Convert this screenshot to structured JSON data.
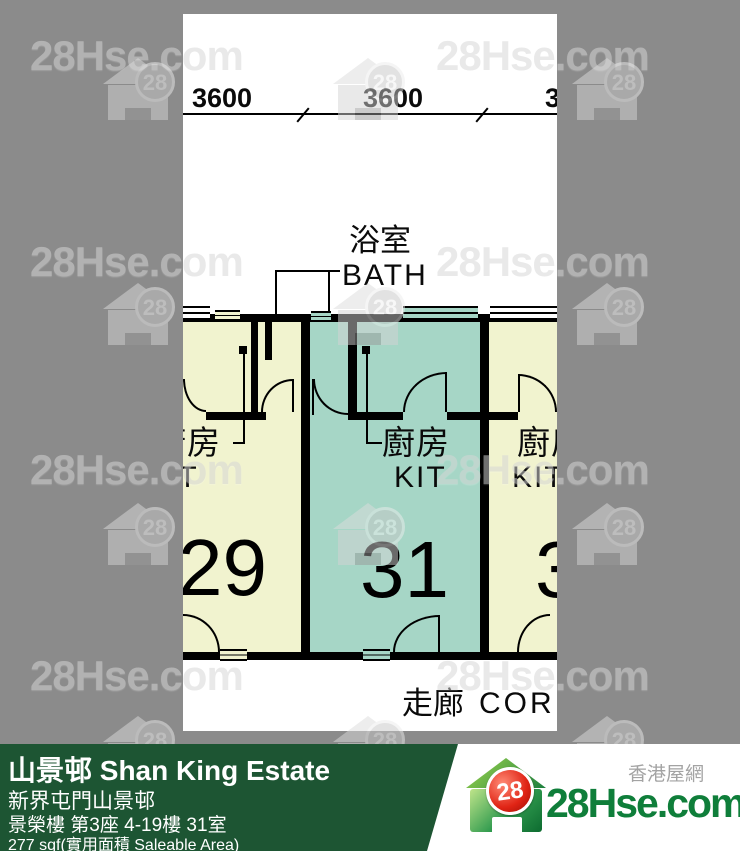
{
  "page": {
    "background_color": "#8b8b8b"
  },
  "watermark": {
    "text": "28Hse.com",
    "badge": "28",
    "text_positions": [
      [
        30,
        32
      ],
      [
        436,
        32
      ],
      [
        30,
        238
      ],
      [
        436,
        238
      ],
      [
        30,
        446
      ],
      [
        436,
        446
      ],
      [
        30,
        652
      ],
      [
        436,
        652
      ]
    ],
    "logo_positions": [
      [
        103,
        58
      ],
      [
        333,
        58
      ],
      [
        572,
        58
      ],
      [
        103,
        283
      ],
      [
        333,
        283
      ],
      [
        572,
        283
      ],
      [
        103,
        503
      ],
      [
        333,
        503
      ],
      [
        572,
        503
      ],
      [
        103,
        716
      ],
      [
        333,
        716
      ],
      [
        572,
        716
      ]
    ]
  },
  "floor_plan": {
    "dimension_labels": [
      "3600",
      "3600",
      "3600"
    ],
    "labels": {
      "bath_zh": "浴室",
      "bath_en": "BATH",
      "kitchen_zh": "廚房",
      "kitchen_en": "KIT",
      "corridor_zh": "走廊",
      "corridor_en": "CORRIDOR"
    },
    "units": [
      {
        "number": "29",
        "fill": "#f1f3cf"
      },
      {
        "number": "31",
        "fill": "#a6d6c6"
      },
      {
        "number": "33",
        "fill": "#f1f3cf"
      }
    ],
    "colors": {
      "wall": "#000000",
      "sheet": "#ffffff"
    }
  },
  "info_bar": {
    "bg_color": "#1d5533",
    "title": "山景邨 Shan King Estate",
    "subtitle": "新界屯門山景邨",
    "address": "景榮樓 第3座 4-19樓 31室",
    "area": "277 sqf(實用面積 Saleable Area)"
  },
  "brand": {
    "site_name": "28Hse.com",
    "site_name_zh": "香港屋網",
    "badge": "28",
    "green": "#0f7e3a",
    "red": "#e02415"
  }
}
